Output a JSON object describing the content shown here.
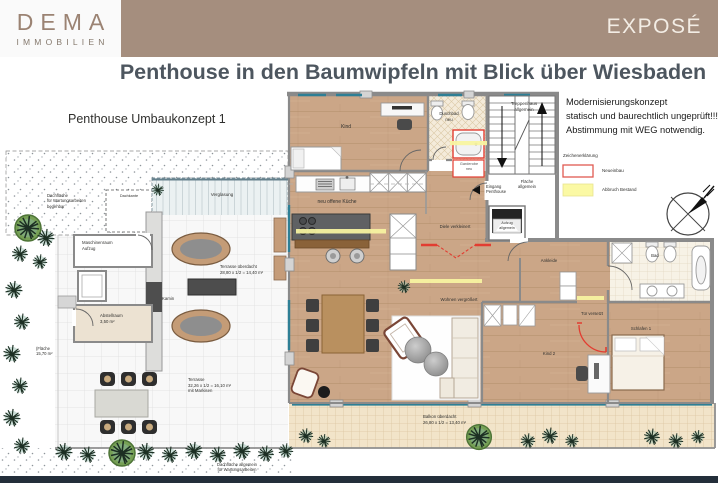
{
  "header": {
    "logo_word": "DEMA",
    "logo_sub": "IMMOBILIEN",
    "expose": "EXPOSÉ"
  },
  "title": "Penthouse in den Baumwipfeln mit Blick über Wiesbaden",
  "plan": {
    "concept": "Penthouse Umbaukonzept 1",
    "notes": "Modernisierungskonzept\nstatisch und baurechtlich ungeprüft!!!\nAbstimmung mit WEG notwendig.",
    "legend": {
      "title": "Zeichenerklärung",
      "neubau": "Neueinbau",
      "abbruch": "Abbruch Bestand"
    },
    "rooms": {
      "treppenhaus": "Treppenhaus\nallgemein",
      "kind1": "Kind",
      "duschbad": "Duschbad\nneu",
      "garderobe": "Garderobe\nneu",
      "eingang": "Eingang\nPenthouse",
      "flaeche": "Fläche\nallgemein",
      "aufzug": "Aufzug\nallgemein",
      "kueche": "neu offene Küche",
      "diele": "Diele verkleinert",
      "ankleide": "Ankleide",
      "wohnen": "Wohnen vergrößert",
      "bad": "Bad",
      "tuer": "Tür versetzt",
      "schlafen1": "Schlafen 1",
      "kind2": "Kind 2",
      "balkon": "Balkon überdacht\n26,80 x 1/2 = 13,40 m²",
      "terrasse_ueberdacht": "Terrasse überdacht\n28,80 x 1/2 = 14,40 m²",
      "kamin": "Kamin",
      "verglasung": "Verglasung",
      "terrasse": "Terrasse\n32,26 x 1/2 = 16,10 m²\nmit Markisen",
      "maschinenraum": "Maschinenraum\nAufzug",
      "abstellraum": "Abstellraum\n3,50 m²",
      "flaeche_klein": "(Fläche\n15,70 m²",
      "dach_links": "Dachfläche\nfür Wartungsarbeiten\nbegehbar",
      "dachkante": "Dachkante",
      "dach_unten": "Dachfläche allgemein\nfür Wartungsarbeiten"
    },
    "colors": {
      "header_taupe": "#a58e7e",
      "title_slate": "#4d565f",
      "accent_red": "#e23d31",
      "abbruch_yellow": "#f8f4a0",
      "wood_floor": "#cba687",
      "window_teal": "#2e7f95",
      "footer_dark": "#232e3a"
    }
  }
}
